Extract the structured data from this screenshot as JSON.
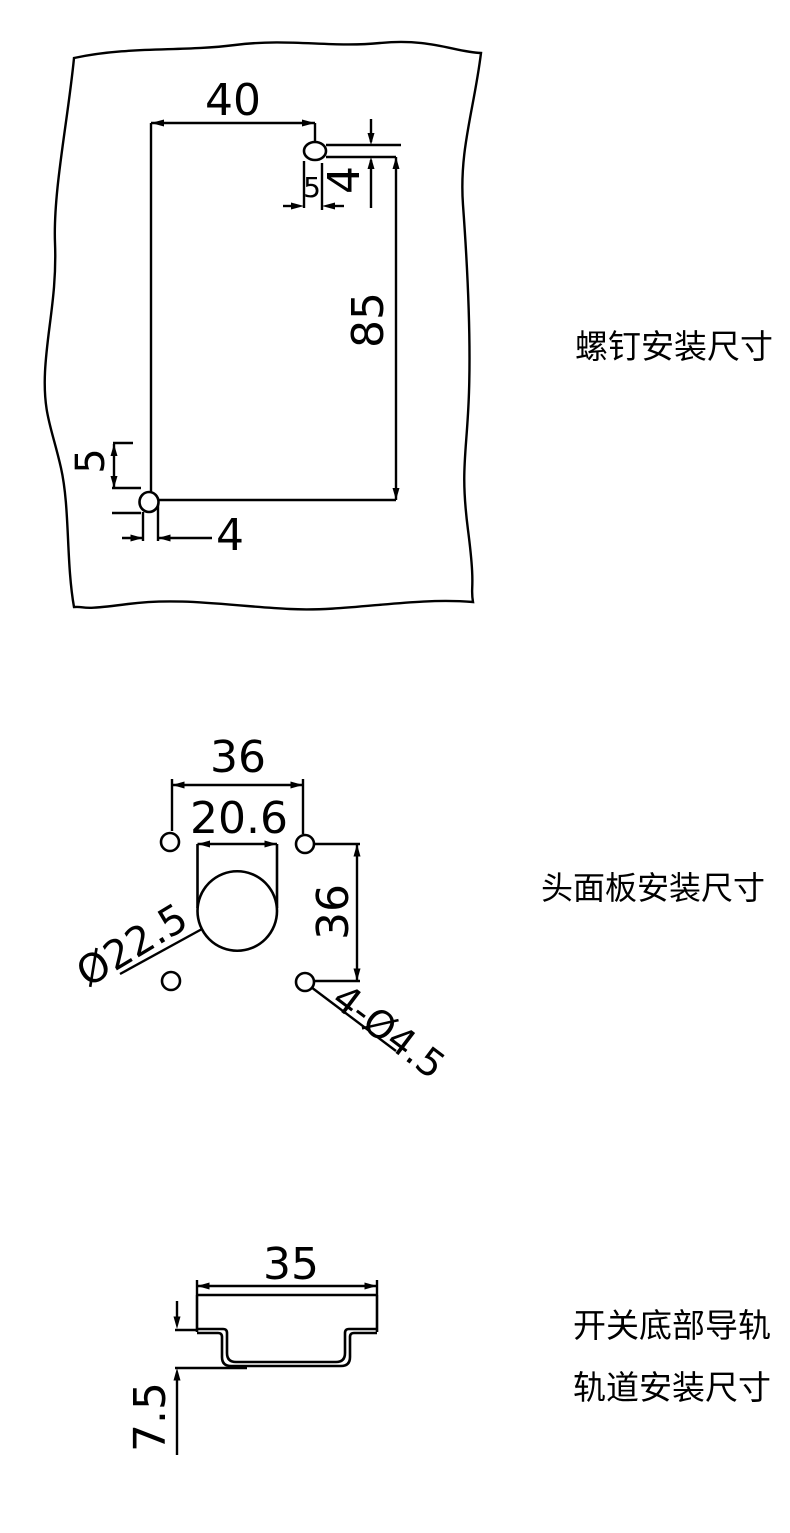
{
  "colors": {
    "background": "#ffffff",
    "line": "#000000",
    "text": "#000000"
  },
  "sections": {
    "screw_mount": {
      "label": "螺钉安装尺寸",
      "dim_width": "40",
      "dim_height": "85",
      "top_screw": {
        "dim_a": "5",
        "dim_b": "4"
      },
      "bottom_screw": {
        "dim_a": "5",
        "dim_b": "4"
      }
    },
    "face_panel": {
      "label": "头面板安装尺寸",
      "dim_hole_spacing_h": "36",
      "dim_slot_width": "20.6",
      "dim_hole_spacing_v": "36",
      "dim_circle": "Ø22.5",
      "dim_holes": "4-Ø4.5"
    },
    "rail": {
      "label_line1": "开关底部导轨",
      "label_line2": "轨道安装尺寸",
      "dim_width": "35",
      "dim_depth": "7.5"
    }
  }
}
